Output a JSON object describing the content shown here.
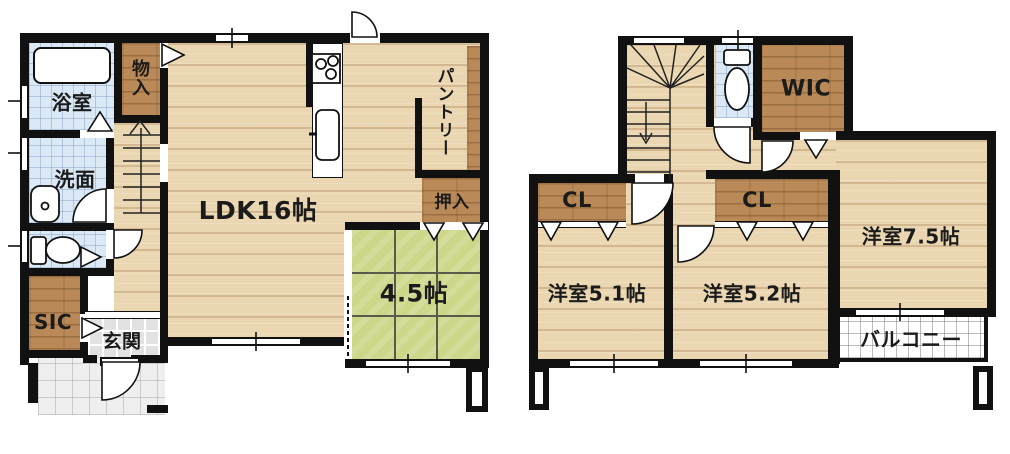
{
  "floor1": {
    "rooms": {
      "bathroom": "浴室",
      "storage": "物入",
      "washroom": "洗面",
      "ldk": "LDK16帖",
      "pantry": "パントリー",
      "futon_closet": "押入",
      "tatami_room": "4.5帖",
      "shoe_closet": "SIC",
      "entrance": "玄関"
    }
  },
  "floor2": {
    "rooms": {
      "walk_in_closet": "WIC",
      "closet_a": "CL",
      "closet_b": "CL",
      "bedroom_a": "洋室5.1帖",
      "bedroom_b": "洋室5.2帖",
      "bedroom_c": "洋室7.5帖",
      "balcony": "バルコニー"
    }
  },
  "colors": {
    "wall": "#111111",
    "wood_floor": "#ead7b2",
    "closet_wood": "#b98a58",
    "tatami_green": "#ced689",
    "wet_area_tile": "#dbe9f6",
    "entry_tile": "#e2e2e2",
    "balcony_floor": "#ffffff"
  }
}
